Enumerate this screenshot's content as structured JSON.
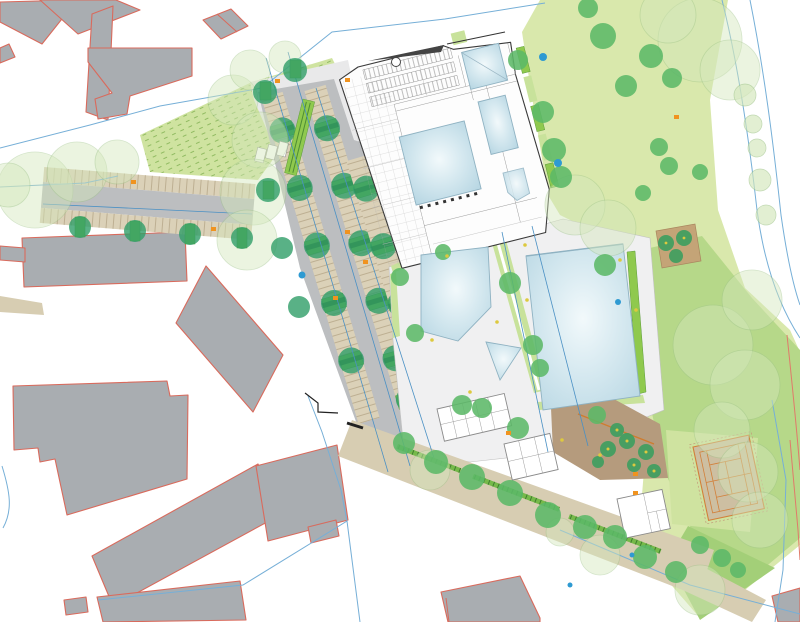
{
  "meta": {
    "title": "Architectural site plan — public swimming pool complex (Freibad/Hallenbad)",
    "canvas": {
      "width": 800,
      "height": 622
    },
    "visible_text": [],
    "orientation": "plan view, no labels rendered"
  },
  "colors": {
    "ctx-building": "#a9adb1",
    "ctx-outline": "#d96a5c",
    "lawn": "#d9e8ac",
    "lawn-mid": "#b6d889",
    "lawn-dark": "#a3cf78",
    "slope": "#cfe3a0",
    "bright-green": "#8fc94e",
    "bright-soft": "#c8e29b",
    "hedge": "#76b94a",
    "deck": "#f0f0f1",
    "plaza": "#e9e9ea",
    "asphalt": "#bcbec0",
    "stall": "#dbd1b8",
    "stall-tick": "#b0a182",
    "tan": "#d7cdb2",
    "brown": "#b59b7d",
    "brown-patch": "#c4a477",
    "pool-stroke": "#8fb2c2",
    "pool-light": "#f2f9fb",
    "pool-mid": "#d6e9f0",
    "pool-deep": "#b5d5e2",
    "tree-green": "#5cb868",
    "tree-teal": "#2f9e68",
    "tree-dark": "#3f9e5f",
    "tree-stripe": "#2a8a57",
    "tree-pale": "#d4e7bb",
    "tree-pale-stroke": "#9fc489",
    "blue-line": "#76afd7",
    "blue-strong": "#4a90c4",
    "blue-dot": "#2e9ad2",
    "marker-orange": "#f0931f",
    "marker-yellow": "#ddc93f",
    "court": "#cdbfa2",
    "court-line": "#d2803a",
    "wall": "#3a3a3a",
    "line-red": "#e07a6a"
  },
  "features": {
    "existing-context-buildings": "gray with red outline",
    "main-bath-building": "white floor plan, indoor pools",
    "indoor-pools": 4,
    "outdoor-pools": 3,
    "parking-rows": 4,
    "tennis-court": 1,
    "tree-lined-street": "west edge",
    "sunbathing-lawn": "east half",
    "beer-garden": "brown terrace with small trees",
    "site-boundary": "light blue lines"
  }
}
